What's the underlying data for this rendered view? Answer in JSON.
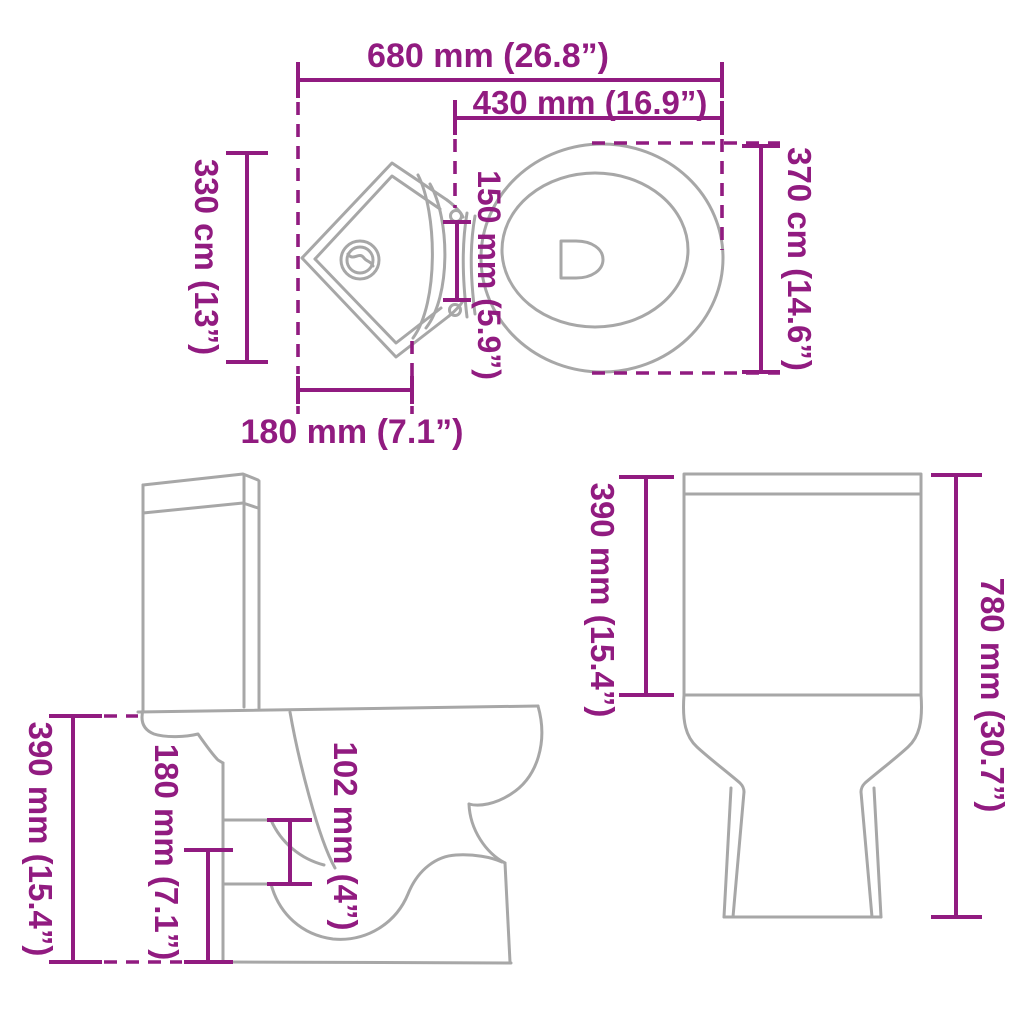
{
  "diagram": {
    "type": "product-dimension-diagram",
    "subject": "corner toilet with cistern shown in top, side and front orthographic views",
    "accent_color": "#911b80",
    "line_color": "#a7a7a7",
    "dims": {
      "overall_width": {
        "view": "top",
        "label": "680 mm (26.8”)"
      },
      "seat_width": {
        "view": "top",
        "label": "430 mm (16.9”)"
      },
      "tank_side_depth": {
        "view": "top",
        "label": "330 cm (13”)"
      },
      "bowl_depth": {
        "view": "top",
        "label": "370 cm (14.6”)"
      },
      "hinge_gap": {
        "view": "top",
        "label": "150 mm (5.9”)"
      },
      "tank_front_width": {
        "view": "top",
        "label": "180 mm (7.1”)"
      },
      "seat_height": {
        "view": "side",
        "label": "390 mm (15.4”)"
      },
      "outlet_height": {
        "view": "side",
        "label": "180 mm (7.1”)"
      },
      "outlet_size": {
        "view": "side",
        "label": "102 mm (4”)"
      },
      "cistern_height": {
        "view": "front",
        "label": "390 mm (15.4”)"
      },
      "total_height": {
        "view": "front",
        "label": "780 mm (30.7”)"
      }
    }
  }
}
